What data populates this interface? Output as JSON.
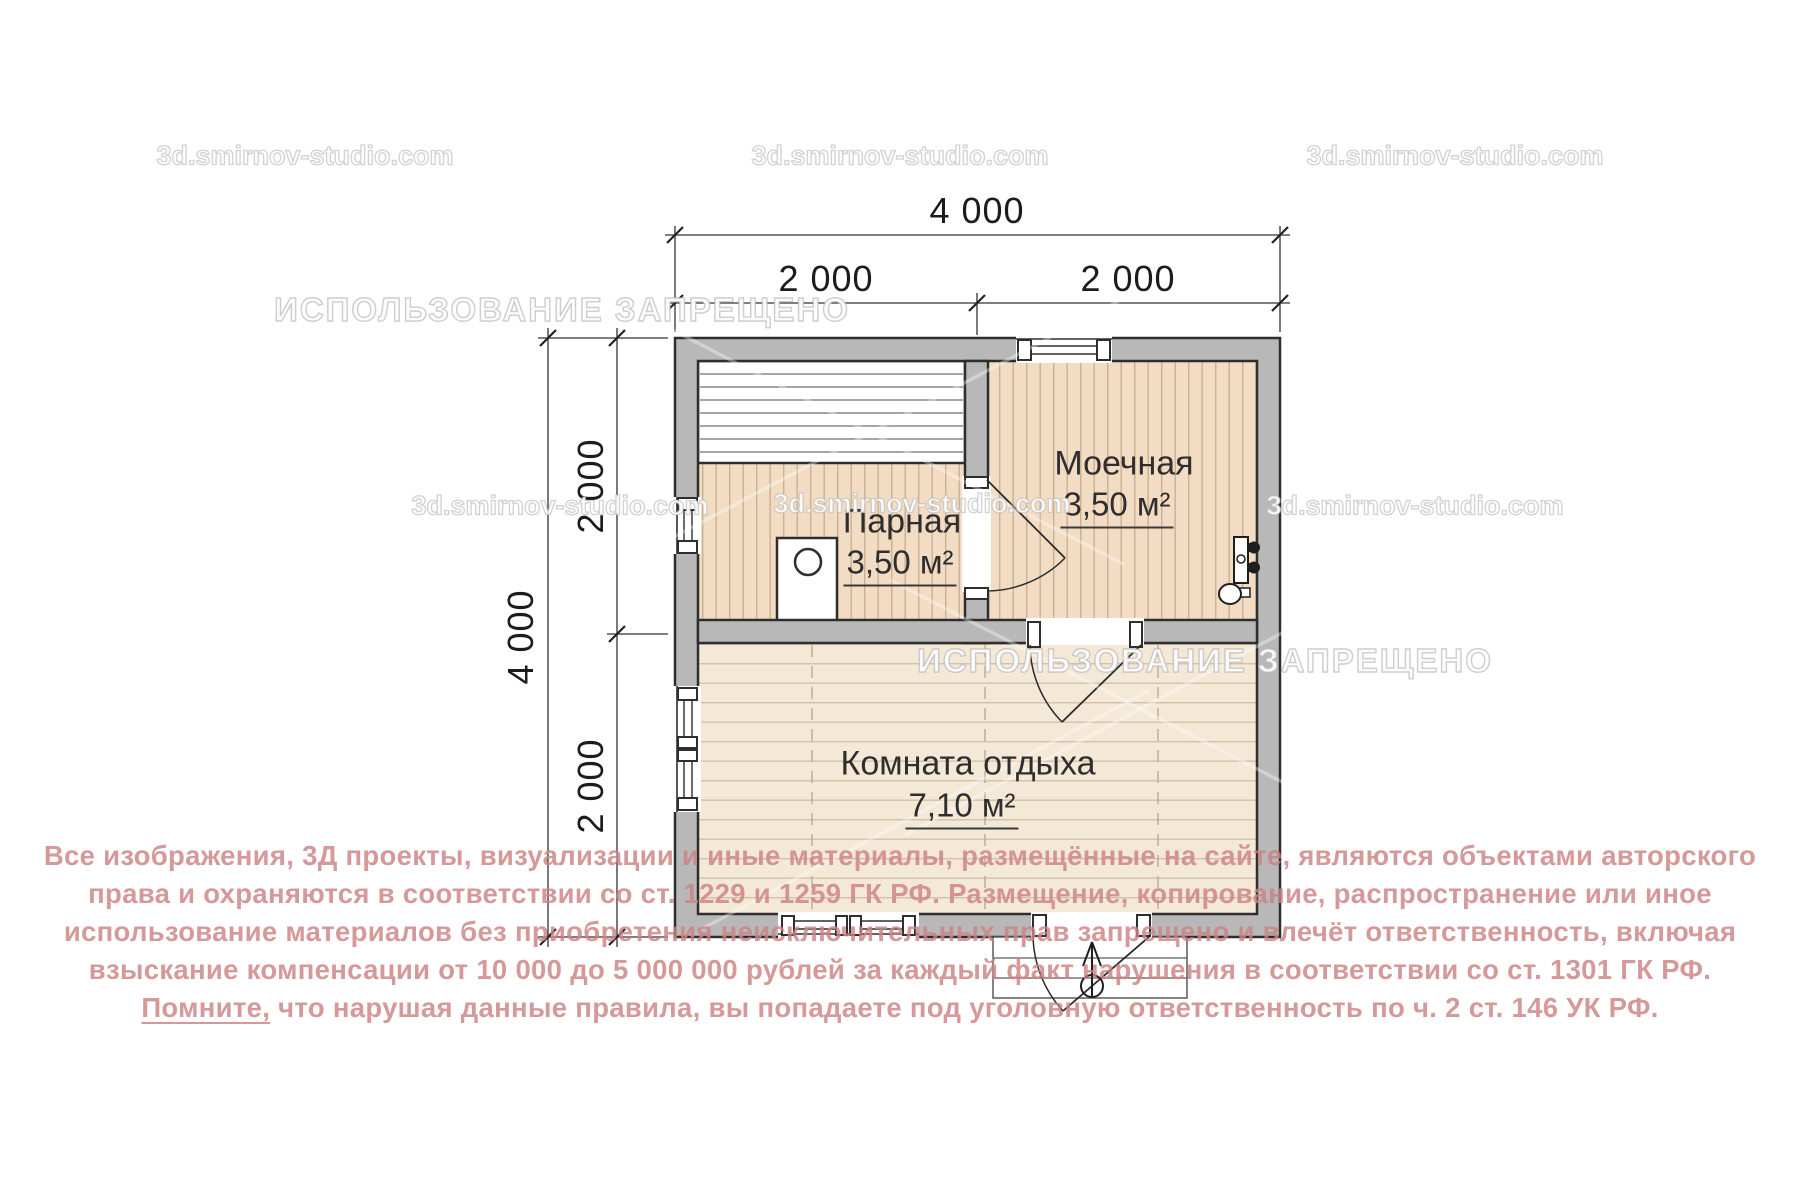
{
  "watermarks": {
    "site": "3d.smirnov-studio.com",
    "prohibited": "ИСПОЛЬЗОВАНИЕ ЗАПРЕЩЕНО"
  },
  "dimensions": {
    "top_total": "4 000",
    "top_left": "2 000",
    "top_right": "2 000",
    "left_total": "4 000",
    "left_upper": "2 000",
    "left_lower": "2 000"
  },
  "rooms": {
    "parnaya": {
      "name": "Парная",
      "area": "3,50 м²"
    },
    "moechnaya": {
      "name": "Моечная",
      "area": "3,50 м²"
    },
    "komnata": {
      "name": "Комната отдыха",
      "area": "7,10 м²"
    }
  },
  "copyright": {
    "line1": "Все изображения, 3Д проекты, визуализации и иные материалы, размещённые на сайте, являются объектами авторского",
    "line2": "права и охраняются в соответствии со ст. 1229 и 1259 ГК РФ. Размещение, копирование, распространение или иное",
    "line3": "использование материалов без приобретения неисключительных прав запрещено и влечёт ответственность, включая",
    "line4": "взыскание компенсации от 10 000 до 5 000 000 рублей за каждый факт нарушения в соответствии со ст. 1301 ГК РФ.",
    "line5_underlined": "Помните,",
    "line5_rest": " что нарушая данные правила, вы попадаете под уголовную ответственность по ч. 2 ст. 146 УК РФ."
  },
  "colors": {
    "wall_gray": "#b8b8b8",
    "outline_dark": "#2e2e2e",
    "floor_plank_vertical": "#f2dcc3",
    "floor_plank_horizontal": "#f4e8d7",
    "copyright_pink": "#cd8383"
  }
}
